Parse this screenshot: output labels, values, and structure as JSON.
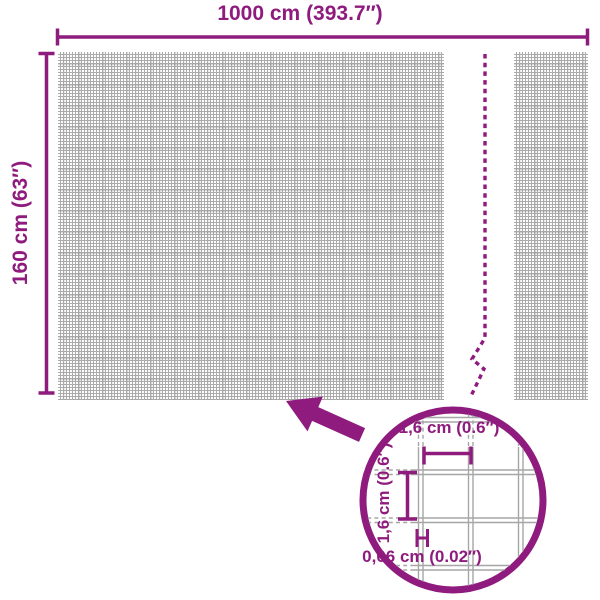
{
  "colors": {
    "accent": "#8e1b7d",
    "mesh_grid": "#ababab",
    "magnified_wire": "#a6a6a6"
  },
  "dimensions": {
    "width_label": "1000 cm (393.7″)",
    "height_label": "160 cm (63″)"
  },
  "magnifier": {
    "cell_width_label": "1,6 cm (0.6″)",
    "cell_height_label": "1,6 cm (0.6″)",
    "wire_thickness_label": "0,06 cm (0.02″)"
  }
}
